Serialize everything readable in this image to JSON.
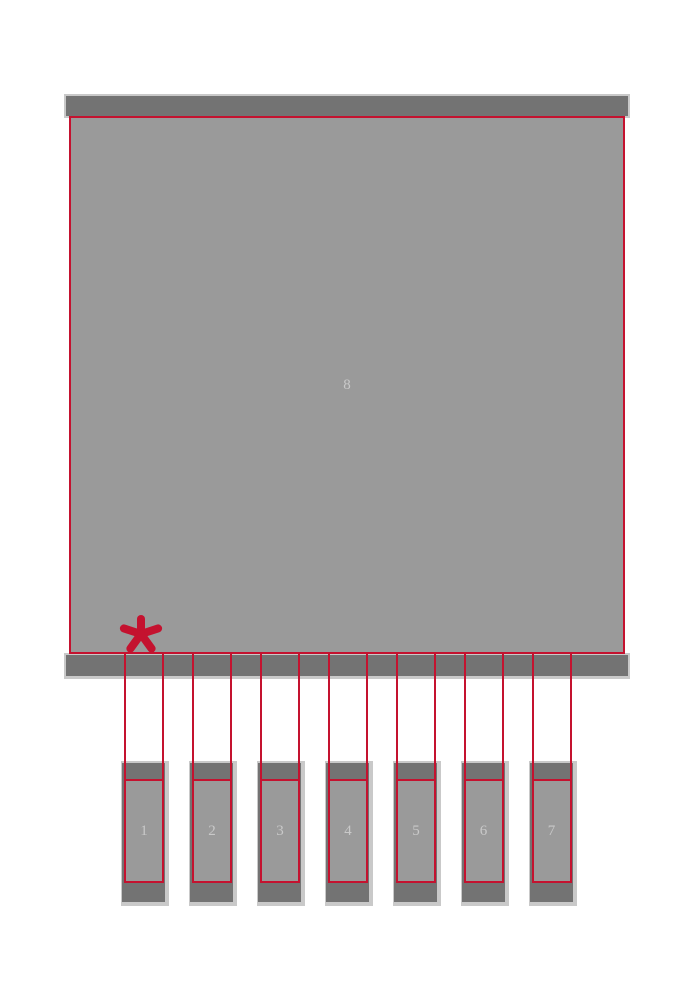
{
  "footprint": {
    "thermal_pad": {
      "number": "8"
    },
    "pins": [
      {
        "number": "1"
      },
      {
        "number": "2"
      },
      {
        "number": "3"
      },
      {
        "number": "4"
      },
      {
        "number": "5"
      },
      {
        "number": "6"
      },
      {
        "number": "7"
      }
    ],
    "pin_one_marker": "asterisk"
  },
  "colors": {
    "background": "#ffffff",
    "pad_dark": "#737373",
    "body_fill": "#9a9a9a",
    "mask_light": "#c9c9c9",
    "outline_red": "#c4122f",
    "label_text": "#c9c9c9"
  }
}
